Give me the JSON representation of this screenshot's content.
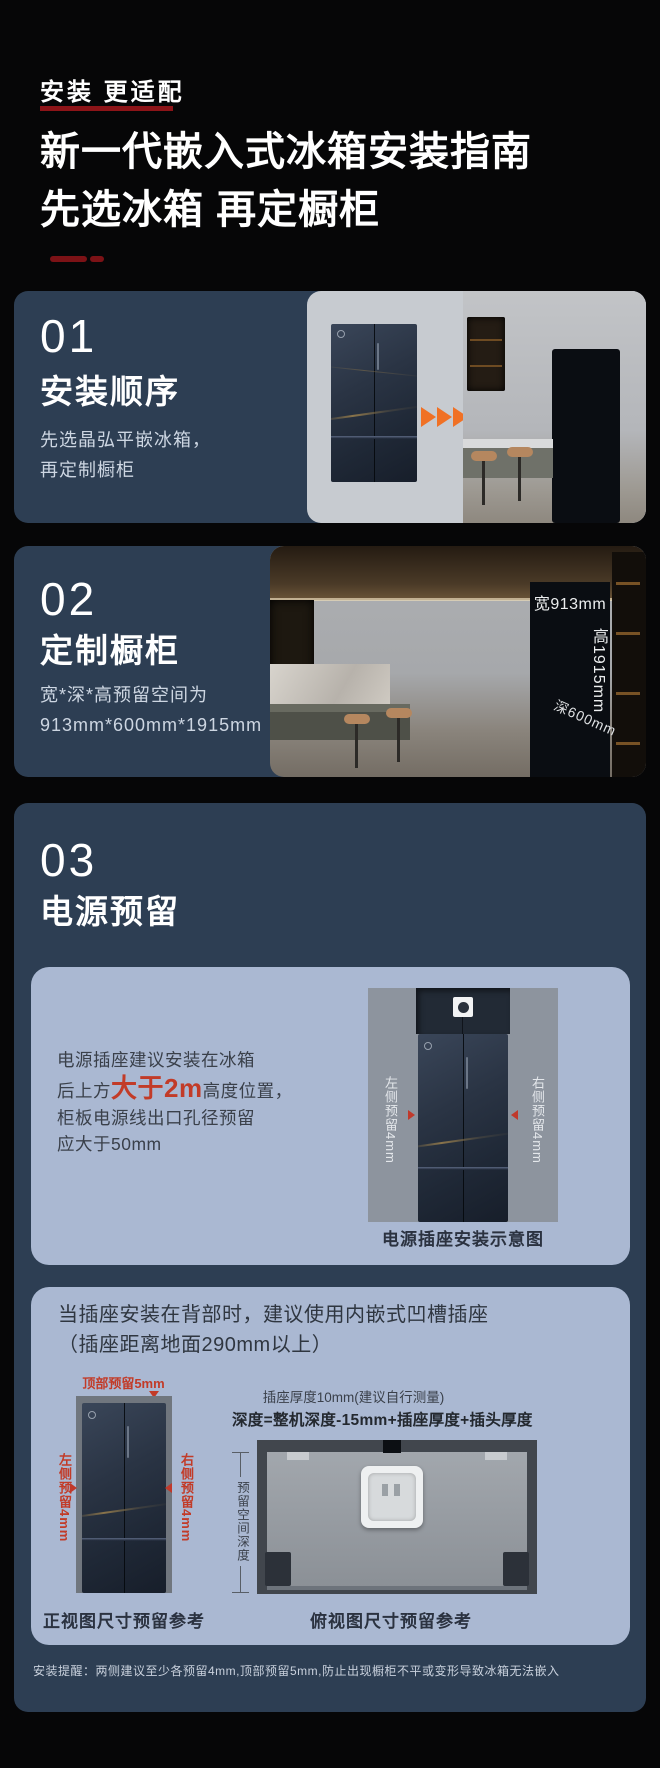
{
  "colors": {
    "accent_red": "#c23b28",
    "underline_red": "#8c1418",
    "card_blue": "#2d3e53",
    "subcard_blue": "#aab8d2",
    "arrow_orange": "#f07125"
  },
  "header": {
    "eyebrow": "安装 更适配",
    "title_line1": "新一代嵌入式冰箱安装指南",
    "title_line2": "先选冰箱 再定橱柜"
  },
  "section1": {
    "number": "01",
    "title": "安装顺序",
    "body_line1": "先选晶弘平嵌冰箱，",
    "body_line2": "再定制橱柜"
  },
  "section2": {
    "number": "02",
    "title": "定制橱柜",
    "body_line1": "宽*深*高预留空间为",
    "body_line2": "913mm*600mm*1915mm",
    "photo_labels": {
      "width": "宽913mm",
      "height": "高1915mm",
      "depth": "深600mm"
    }
  },
  "section3": {
    "number": "03",
    "title": "电源预留",
    "socket_card": {
      "text_line1": "电源插座建议安装在冰箱",
      "text_line2_prefix": "后上方",
      "text_line2_highlight": "大于2m",
      "text_line2_suffix": "高度位置，",
      "text_line3": "柜板电源线出口孔径预留",
      "text_line4": "应大于50mm",
      "label_left": "左侧预留4mm",
      "label_right": "右侧预留4mm",
      "caption": "电源插座安装示意图"
    },
    "recess_card": {
      "heading_line1": "当插座安装在背部时，建议使用内嵌式凹槽插座",
      "heading_line2": "（插座距离地面290mm以上）",
      "front_view": {
        "label_top": "顶部预留5mm",
        "label_left": "左侧预留4mm",
        "label_right": "右侧预留4mm",
        "caption": "正视图尺寸预留参考"
      },
      "top_view": {
        "note": "插座厚度10mm(建议自行测量)",
        "formula": "深度=整机深度-15mm+插座厚度+插头厚度",
        "label_depth": "预留空间深度",
        "caption": "俯视图尺寸预留参考"
      }
    },
    "footnote": "安装提醒：两侧建议至少各预留4mm,顶部预留5mm,防止出现橱柜不平或变形导致冰箱无法嵌入"
  }
}
